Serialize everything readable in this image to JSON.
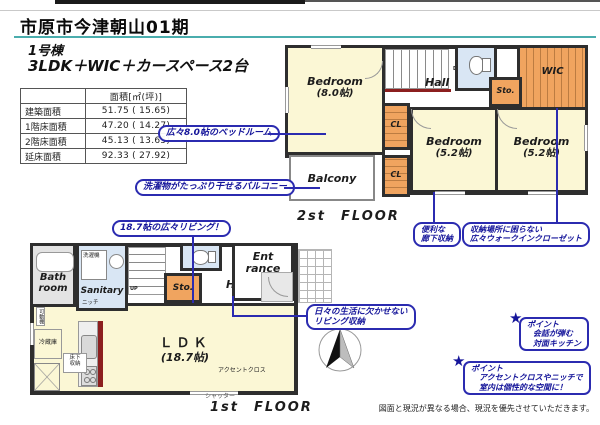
{
  "header": {
    "title": "市原市今津朝山01期",
    "building": "1号棟",
    "spec": "3LDK＋WIC＋カースペース2台"
  },
  "area_table": {
    "unit_header": "面積[㎡(坪)]",
    "rows": [
      {
        "label": "建築面積",
        "value": "51.75 ( 15.65)"
      },
      {
        "label": "1階床面積",
        "value": "47.20 ( 14.27)"
      },
      {
        "label": "2階床面積",
        "value": "45.13 ( 13.65)"
      },
      {
        "label": "延床面積",
        "value": "92.33 ( 27.92)"
      }
    ]
  },
  "floor2": {
    "floor_label": "2st　FLOOR",
    "bedroom_main": {
      "name": "Bedroom",
      "size": "(8.0帖)"
    },
    "bedroom_center": {
      "name": "Bedroom",
      "size": "(5.2帖)"
    },
    "bedroom_right": {
      "name": "Bedroom",
      "size": "(5.2帖)"
    },
    "hall": "Hall",
    "sto": "Sto.",
    "wic": "WIC",
    "cl_upper": "CL",
    "cl_lower": "CL",
    "balcony": "Balcony",
    "stairs_dn": "DN",
    "callout_bedroom": "広々8.0帖のベッドルーム",
    "callout_balcony": "洗濯物がたっぷり干せるバルコニー",
    "callout_hall_storage": {
      "line1": "便利な",
      "line2": "廊下収納"
    },
    "callout_wic": {
      "line1": "収納場所に困らない",
      "line2": "広々ウォークインクローゼット"
    }
  },
  "floor1": {
    "floor_label": "1st　FLOOR",
    "bath": {
      "line1": "Bath",
      "line2": "room"
    },
    "sanitary": "Sanitary",
    "washer": "洗濯機",
    "sto": "Sto.",
    "hall": "Hall",
    "entrance": {
      "line1": "Ent",
      "line2": "rance"
    },
    "ldk": {
      "name": "ＬＤＫ",
      "size": "(18.7帖)"
    },
    "stairs_up": "UP",
    "fridge": "冷蔵庫",
    "underfloor_storage": "床下収納",
    "movable_shelf": "可動棚",
    "niche": "ニッチ",
    "accent_cloth": "アクセントクロス",
    "shutter": "シャッター",
    "callout_living": "18.7帖の広々リビング！",
    "callout_living_storage": {
      "line1": "日々の生活に欠かせない",
      "line2": "リビング収納"
    },
    "point_kitchen": {
      "star": "★",
      "title": "ポイント",
      "line1": "会話が弾む",
      "line2": "対面キッチン"
    },
    "point_accent": {
      "star": "★",
      "title": "ポイント",
      "line1": "アクセントクロスやニッチで",
      "line2": "室内は個性的な空間に！"
    }
  },
  "footer": {
    "disclaimer": "図面と現況が異なる場合、現況を優先させていただきます。"
  },
  "colors": {
    "room_yellow": "#FBF7D5",
    "storage_orange": "#F0A45F",
    "water_blue": "#D9E6F4",
    "wall": "#2e2e2e",
    "accent_red": "#8C1F1F",
    "callout_navy": "#2b2bb0",
    "teal_underline": "#4AADAD"
  }
}
